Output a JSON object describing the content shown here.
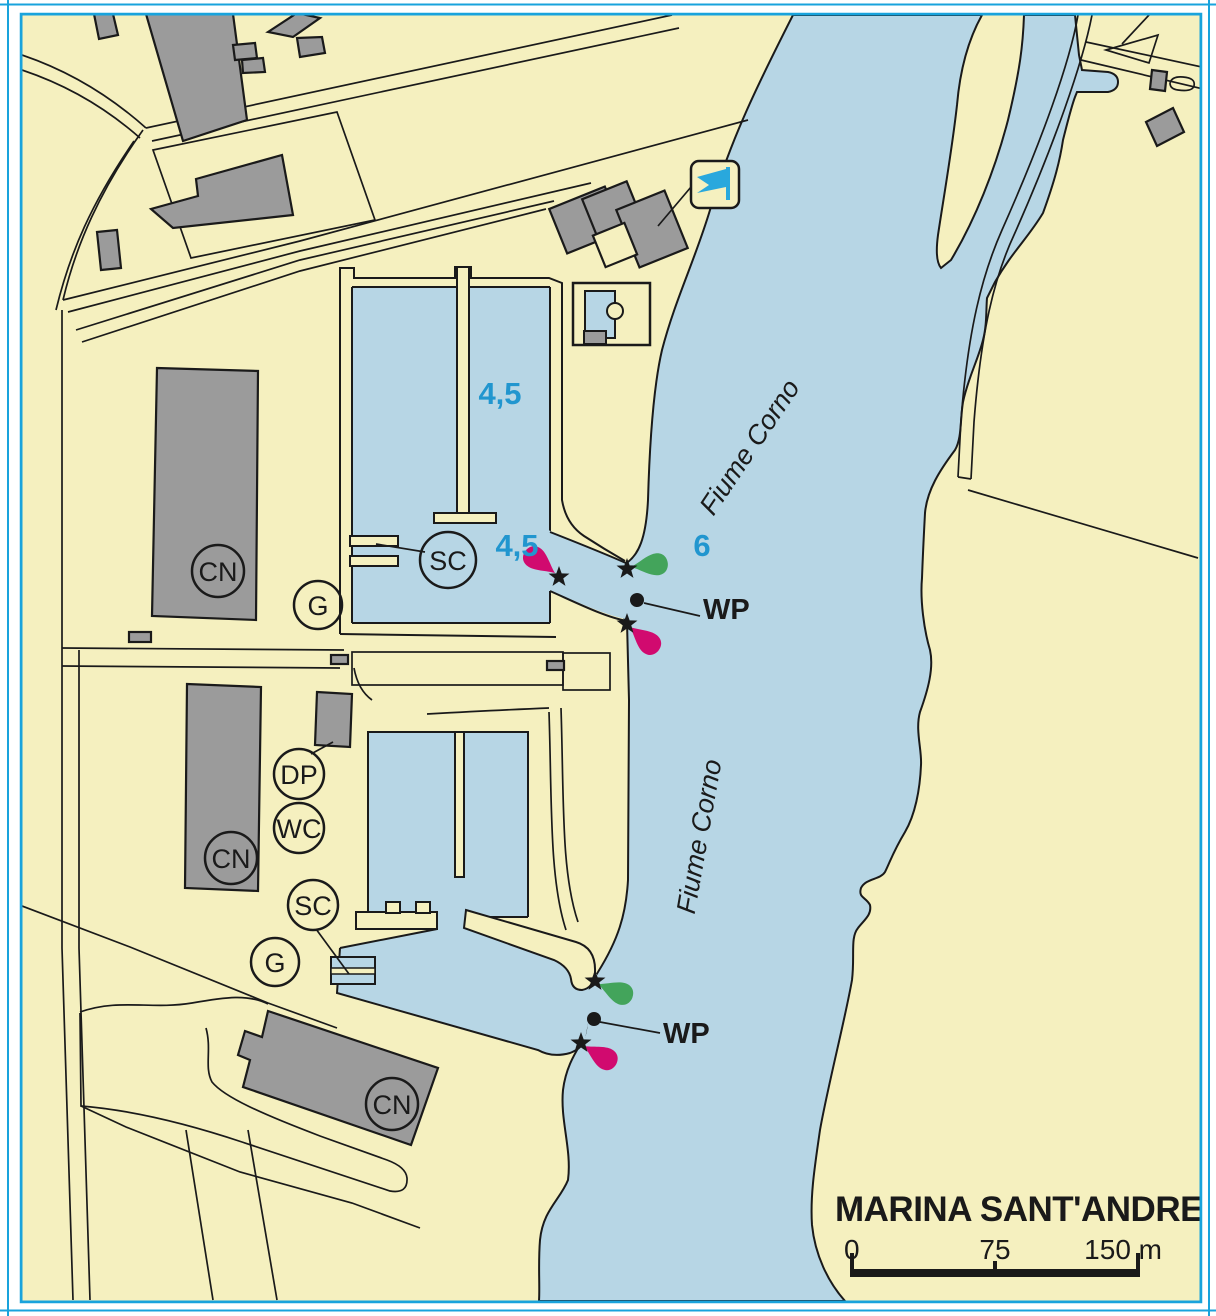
{
  "map": {
    "title": "MARINA SANT'ANDREA",
    "river_name": "Fiume Corno",
    "waypoint_label": "WP",
    "labels": {
      "cn": "CN",
      "g": "G",
      "sc": "SC",
      "dp": "DP",
      "wc": "WC"
    },
    "depths": {
      "basin": "4,5",
      "entrance": "4,5",
      "river": "6"
    },
    "scale_bar": {
      "zero": "0",
      "mid": "75",
      "end": "150 m"
    },
    "colors": {
      "land": "#f5f0bf",
      "water": "#b7d6e5",
      "building": "#9b9b9b",
      "outline": "#1a1a1a",
      "frame": "#19a3dc",
      "depth_text": "#2196cf",
      "light_magenta": "#d10a6f",
      "light_green": "#43a45b",
      "flag_blue": "#29a8dd"
    },
    "symbols": {
      "lights": "star-with-flare",
      "waypoint": "dot-with-leader",
      "club": "blue-flag"
    }
  }
}
